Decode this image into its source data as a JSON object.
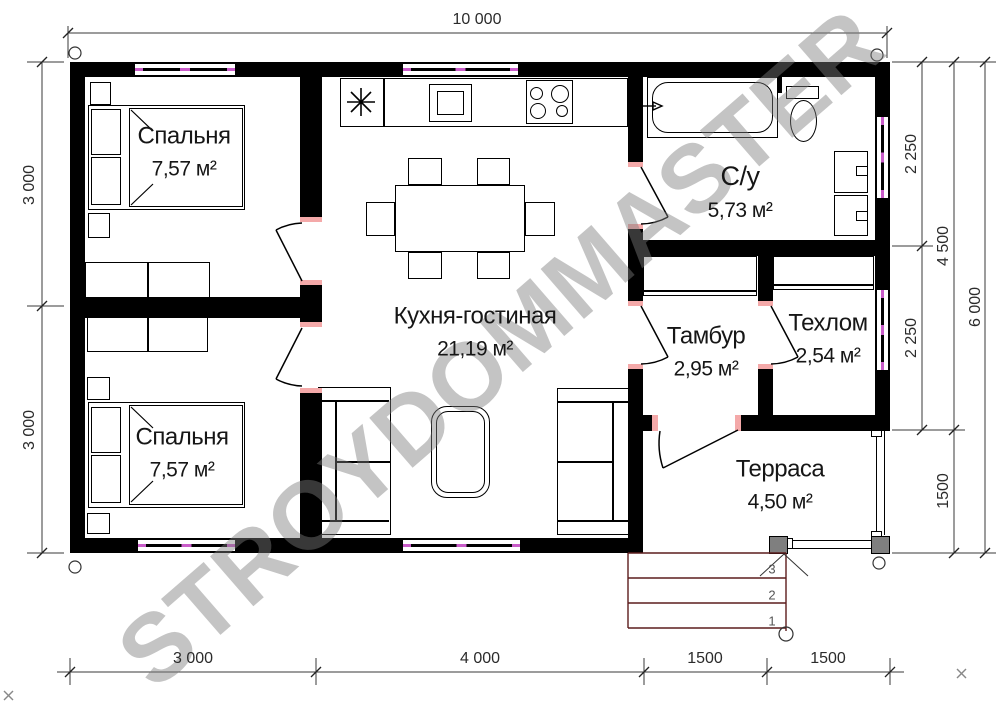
{
  "watermark": "STROYDOMMASTER",
  "rooms": {
    "bedroom1": {
      "name": "Спальня",
      "area": "7,57 м²"
    },
    "bedroom2": {
      "name": "Спальня",
      "area": "7,57 м²"
    },
    "kitchen": {
      "name": "Кухня-гостиная",
      "area": "21,19 м²"
    },
    "bathroom": {
      "name": "С/у",
      "area": "5,73 м²"
    },
    "tambour": {
      "name": "Тамбур",
      "area": "2,95 м²"
    },
    "tehroom": {
      "name": "Техлом",
      "area": "2,54 м²"
    },
    "terrace": {
      "name": "Терраса",
      "area": "4,50 м²"
    }
  },
  "dimensions": {
    "top_width": "10 000",
    "left_upper": "3 000",
    "left_lower": "3 000",
    "right_bath": "2 250",
    "right_hall": "2 250",
    "right_main": "4 500",
    "right_terrace": "1500",
    "right_total": "6 000",
    "bottom_bedrooms": "3 000",
    "bottom_kitchen": "4 000",
    "bottom_tambour": "1500",
    "bottom_terrace": "1500"
  },
  "steps": {
    "step3": "3",
    "step2": "2",
    "step1": "1"
  },
  "colors": {
    "wall": "#000000",
    "door_jamb": "#f4a9a9",
    "window_glass": "#c95cc9",
    "steps_line": "#5c1d1d",
    "post_gray": "#7f7f7f",
    "watermark_gray": "rgba(125,125,125,0.45)"
  }
}
